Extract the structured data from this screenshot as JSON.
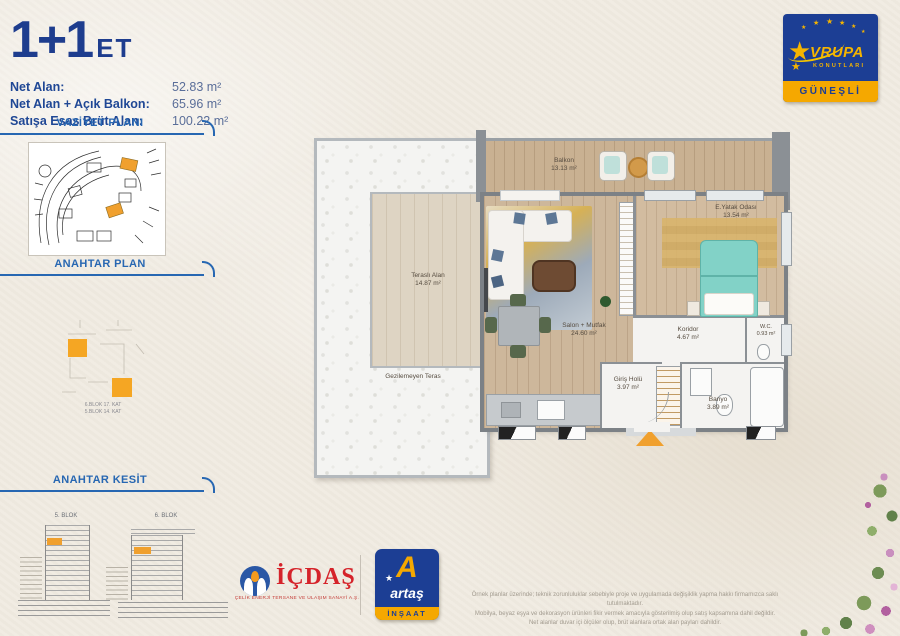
{
  "header": {
    "title": "1+1",
    "title_suffix": "ET",
    "areas": [
      {
        "label": "Net Alan:",
        "value": "52.83 m²"
      },
      {
        "label": "Net Alan + Açık Balkon:",
        "value": "65.96 m²"
      },
      {
        "label": "Satışa Esas Brüt Alan:",
        "value": "100.22 m²"
      }
    ]
  },
  "brand": {
    "star": "★",
    "name": "VRUPA",
    "sub": "KONUTLARI",
    "location": "GÜNEŞLİ",
    "colors": {
      "blue": "#1c3e94",
      "yellow": "#f5a800"
    }
  },
  "sidebar": {
    "vaziyet_title": "VAZİYET PLANI",
    "anahtar_plan_title": "ANAHTAR PLAN",
    "anahtar_kesit_title": "ANAHTAR KESİT",
    "plan_notes": [
      "6.BLOK 17. KAT",
      "5.BLOK 14. KAT"
    ],
    "kesit_blocks": [
      "5. BLOK",
      "6. BLOK"
    ]
  },
  "floorplan": {
    "rooms": {
      "balkon": {
        "name": "Balkon",
        "area": "13.13 m²"
      },
      "terasli": {
        "name": "Teraslı Alan",
        "area": "14.87 m²"
      },
      "teras": {
        "name": "Gezilemeyen Teras"
      },
      "salon": {
        "name": "Salon + Mutfak",
        "area": "24.60 m²"
      },
      "yatak": {
        "name": "E.Yatak Odası",
        "area": "13.54 m²"
      },
      "koridor": {
        "name": "Koridor",
        "area": "4.67 m²"
      },
      "giris": {
        "name": "Giriş Holü",
        "area": "3.97 m²"
      },
      "banyo": {
        "name": "Banyo",
        "area": "3.89 m²"
      },
      "wc": {
        "name": "W.C.",
        "area": "0.93 m²"
      }
    }
  },
  "footer": {
    "icdas_name": "İÇDAŞ",
    "icdas_tagline": "ÇELİK ENERJİ TERSANE VE ULAŞIM SANAYİ A.Ş.",
    "artas_name": "artaş",
    "artas_sub": "İNŞAAT",
    "disclaimer": [
      "Örnek planlar üzerinde; teknik zorunluluklar sebebiyle proje ve uygulamada değişiklik yapma hakkı firmamızca saklı tutulmaktadır.",
      "Mobilya, beyaz eşya ve dekorasyon ürünleri fikir vermek amacıyla gösterilmiş olup satış kapsamına dahil değildir.",
      "Net alanlar duvar içi ölçüler olup, brüt alanlara ortak alan payları dahildir."
    ]
  }
}
